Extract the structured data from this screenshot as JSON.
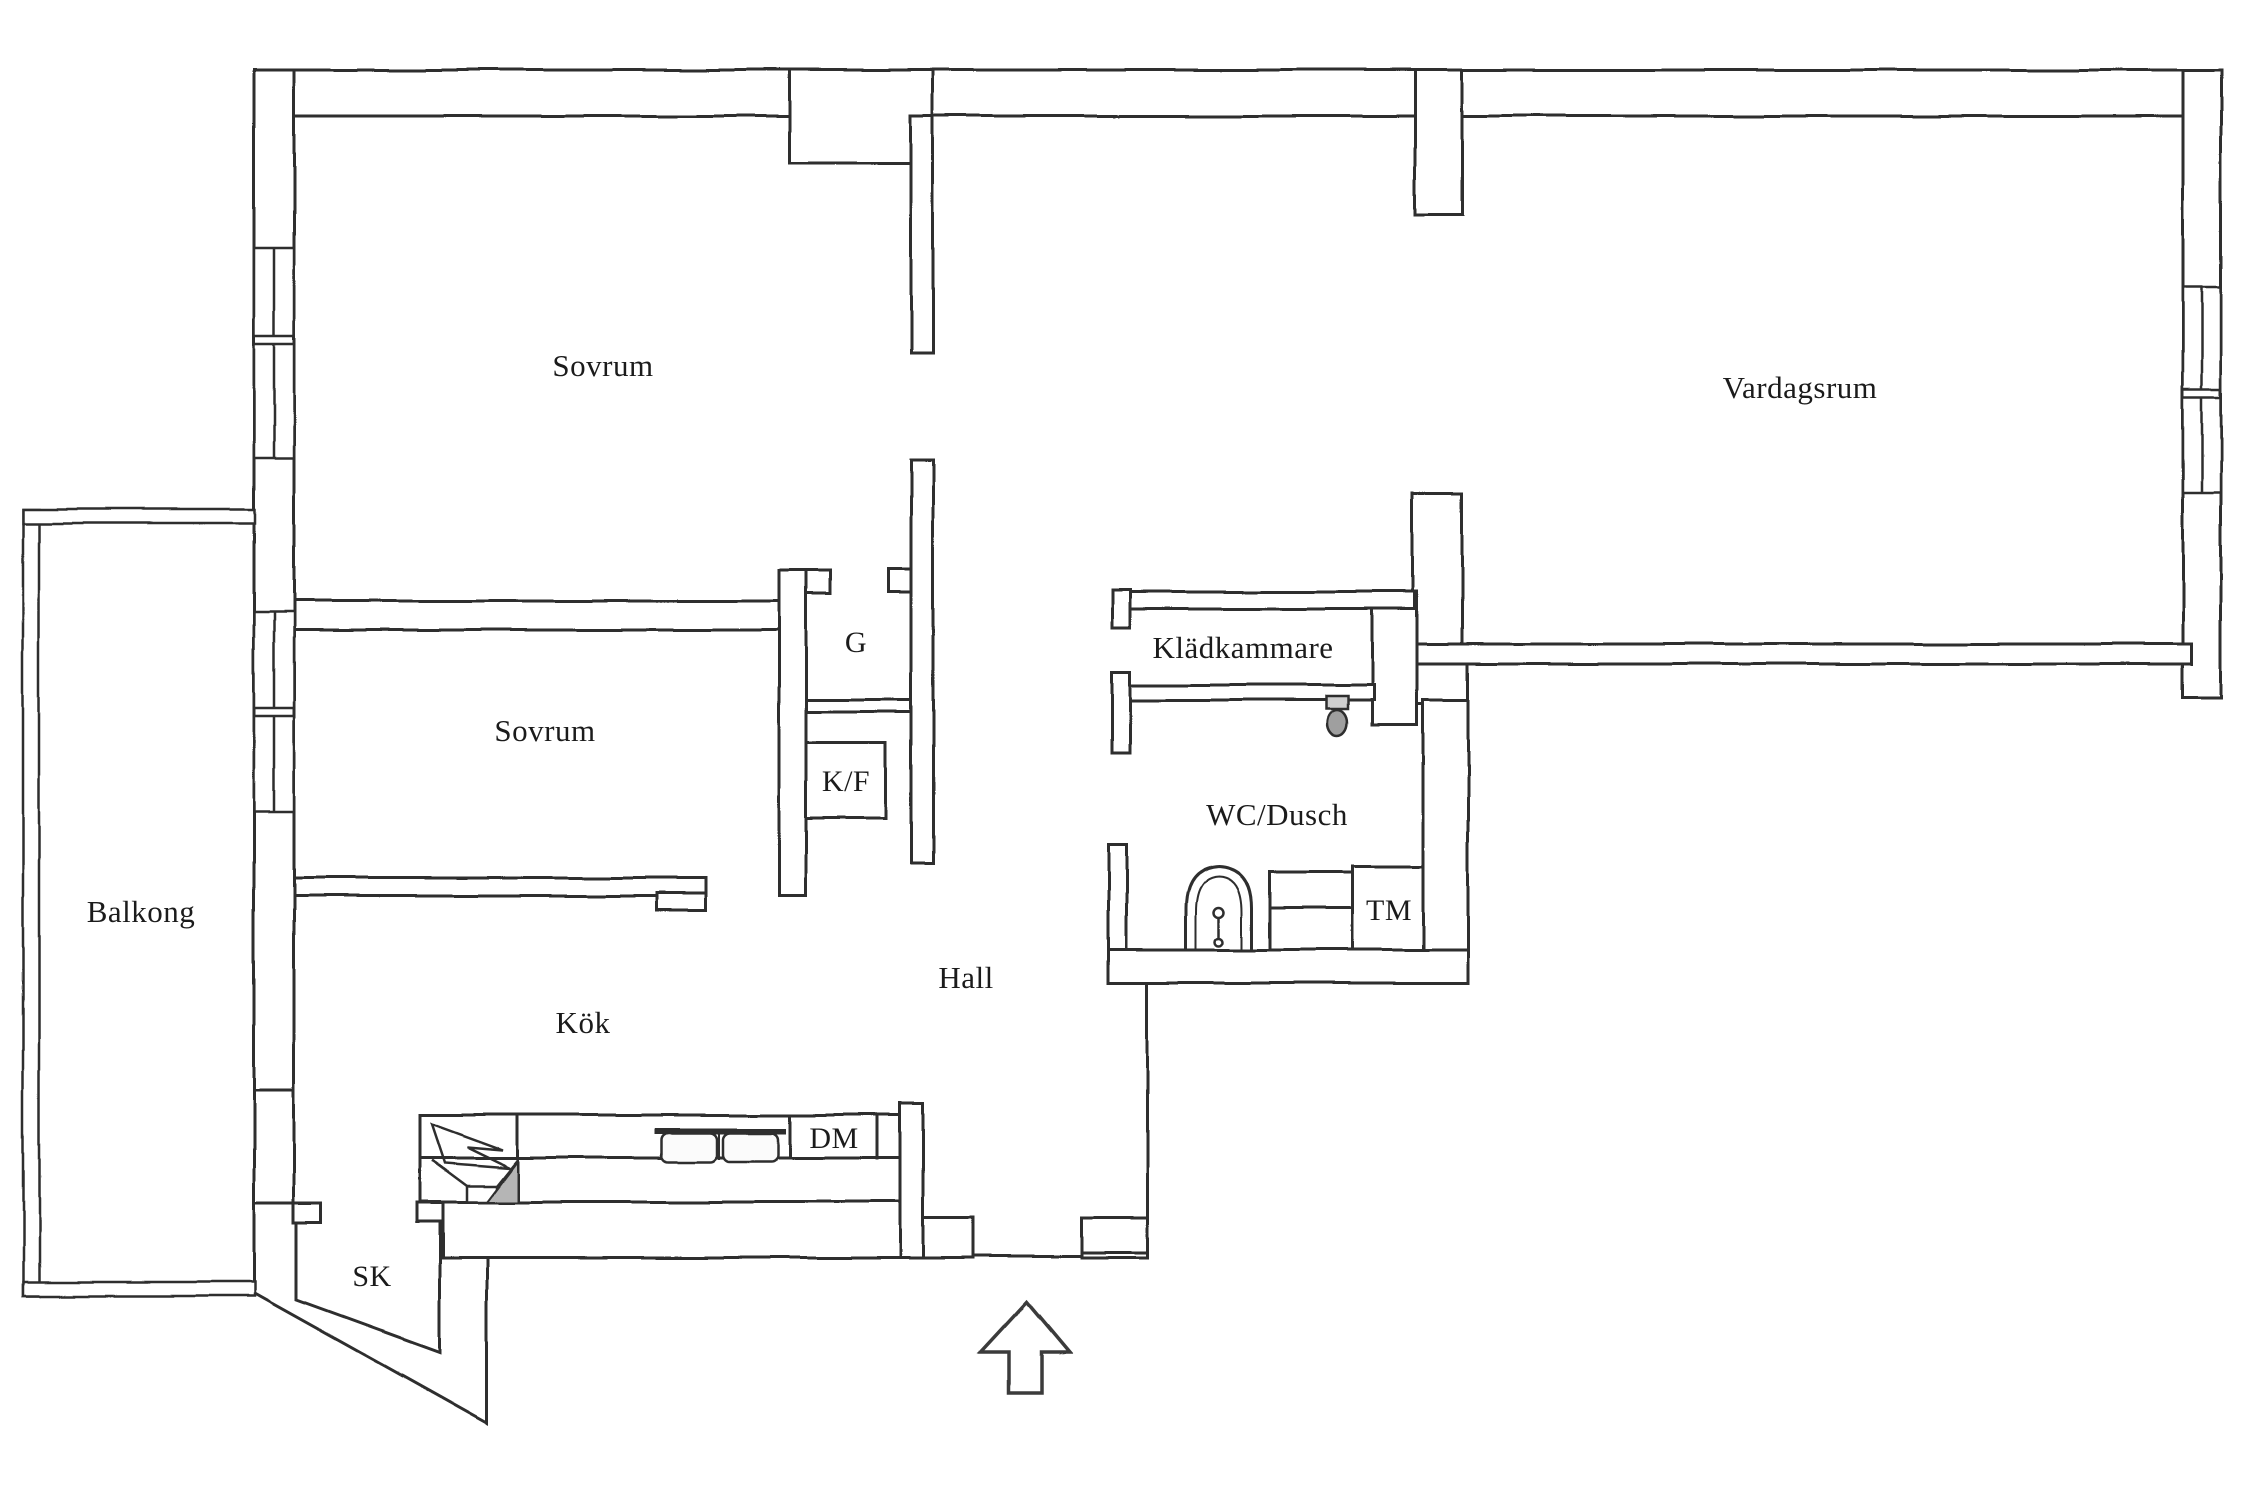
{
  "document": {
    "type": "apartment floor plan",
    "style": "hand-drawn line drawing",
    "language": "Swedish"
  },
  "colors": {
    "background": "#ffffff",
    "wall_line": "#2e2e2e",
    "text": "#1b1b1b",
    "shaded_counter_corner": "#b5b5b5",
    "toilet_fill": "#9f9f9f"
  },
  "rooms": [
    {
      "id": "sovrum-1",
      "label": "Sovrum"
    },
    {
      "id": "vardagsrum",
      "label": "Vardagsrum"
    },
    {
      "id": "sovrum-2",
      "label": "Sovrum"
    },
    {
      "id": "balkong",
      "label": "Balkong"
    },
    {
      "id": "kladkammare",
      "label": "Klädkammare"
    },
    {
      "id": "wc-dusch",
      "label": "WC/Dusch"
    },
    {
      "id": "hall",
      "label": "Hall"
    },
    {
      "id": "kok",
      "label": "Kök"
    },
    {
      "id": "sk",
      "label": "SK"
    }
  ],
  "units": [
    {
      "id": "g",
      "label": "G"
    },
    {
      "id": "kf",
      "label": "K/F"
    },
    {
      "id": "dm",
      "label": "DM"
    },
    {
      "id": "tm",
      "label": "TM"
    }
  ],
  "icons": [
    {
      "name": "entrance-arrow-icon",
      "meaning": "entrance direction arrow pointing up into apartment"
    },
    {
      "name": "toilet-icon",
      "meaning": "toilet in WC/Dusch"
    },
    {
      "name": "washbasin-icon",
      "meaning": "washbasin in WC/Dusch"
    },
    {
      "name": "kitchen-sink-icon",
      "meaning": "double basin kitchen sink"
    },
    {
      "name": "stove-corner-icon",
      "meaning": "kitchen corner unit with fan symbol"
    },
    {
      "name": "window-icon",
      "meaning": "window symbols in outer walls"
    }
  ]
}
